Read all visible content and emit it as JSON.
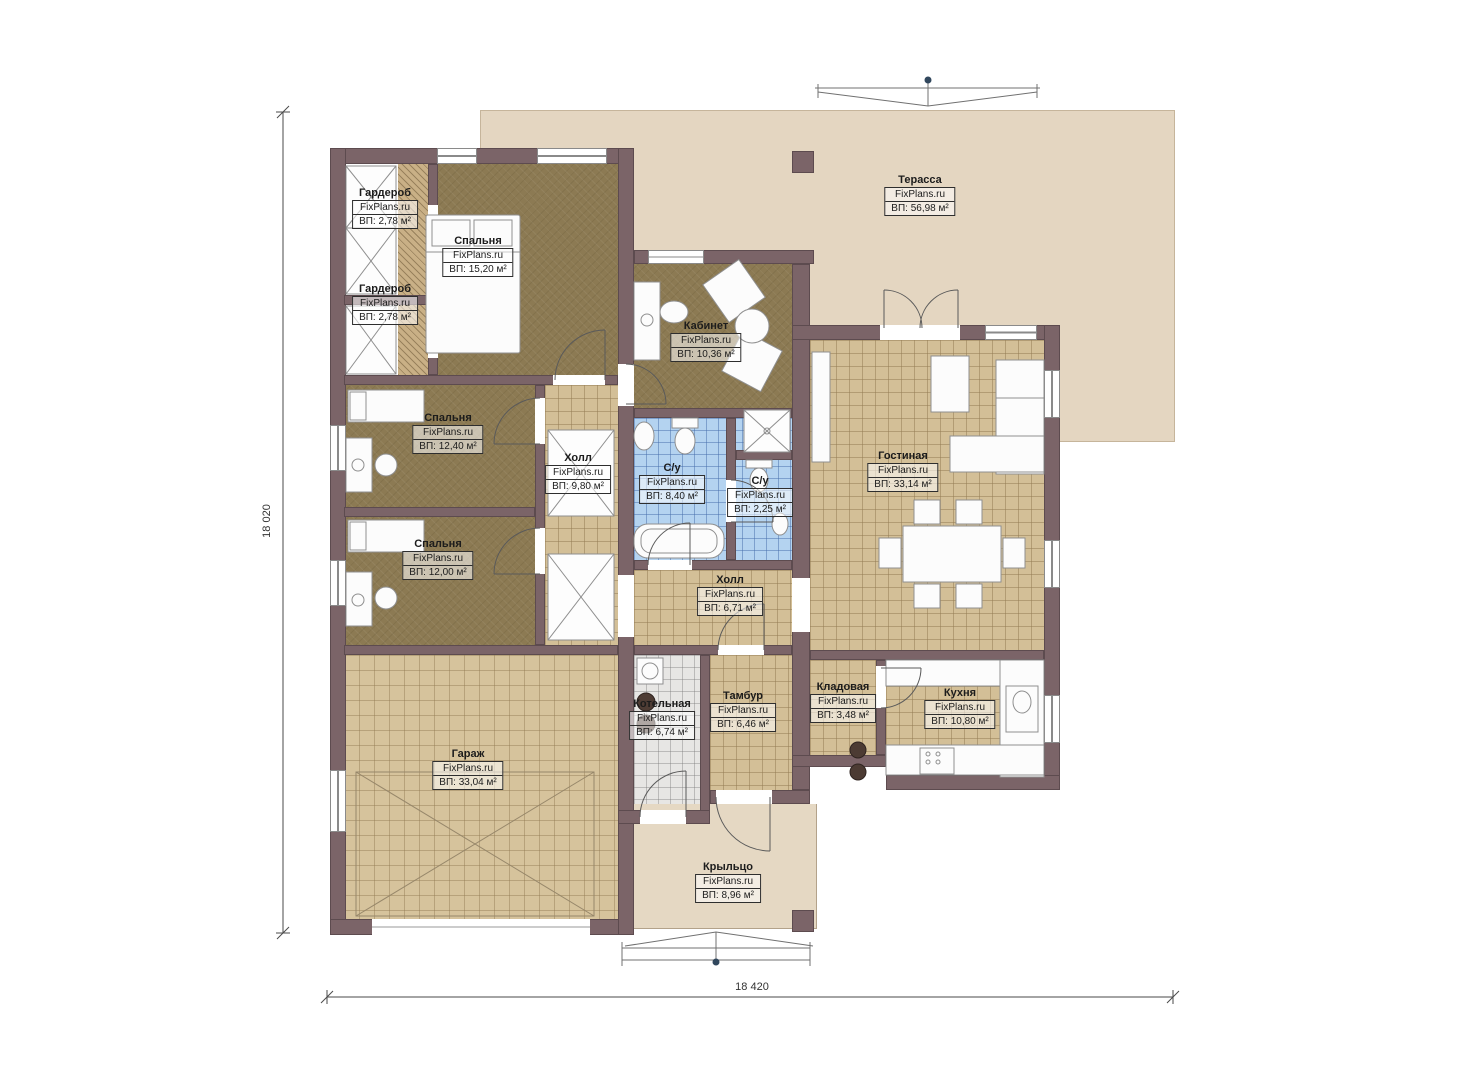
{
  "watermark": "FixPlans.ru",
  "dimensions": {
    "height": "18 020",
    "width": "18 420"
  },
  "rooms": [
    {
      "name": "Гардероб",
      "area": "ВП: 2,78 м²"
    },
    {
      "name": "Спальня",
      "area": "ВП: 15,20 м²"
    },
    {
      "name": "Гардероб",
      "area": "ВП: 2,78 м²"
    },
    {
      "name": "Спальня",
      "area": "ВП: 12,40 м²"
    },
    {
      "name": "Холл",
      "area": "ВП: 9,80 м²"
    },
    {
      "name": "Кабинет",
      "area": "ВП: 10,36 м²"
    },
    {
      "name": "С/у",
      "area": "ВП: 8,40 м²"
    },
    {
      "name": "С/у",
      "area": "ВП: 2,25 м²"
    },
    {
      "name": "Гостиная",
      "area": "ВП: 33,14 м²"
    },
    {
      "name": "Спальня",
      "area": "ВП: 12,00 м²"
    },
    {
      "name": "Холл",
      "area": "ВП: 6,71 м²"
    },
    {
      "name": "Котельная",
      "area": "ВП: 6,74 м²"
    },
    {
      "name": "Тамбур",
      "area": "ВП: 6,46 м²"
    },
    {
      "name": "Кладовая",
      "area": "ВП: 3,48 м²"
    },
    {
      "name": "Кухня",
      "area": "ВП: 10,80 м²"
    },
    {
      "name": "Гараж",
      "area": "ВП: 33,04 м²"
    },
    {
      "name": "Крыльцо",
      "area": "ВП: 8,96 м²"
    },
    {
      "name": "Терасса",
      "area": "ВП: 56,98 м²"
    }
  ],
  "colors": {
    "wall": "#7b6468",
    "floor_olive": "#8c7a53",
    "floor_tan": "#d3bf97",
    "tile_blue": "#b4d3f0",
    "terrace": "#e4d6c1"
  }
}
